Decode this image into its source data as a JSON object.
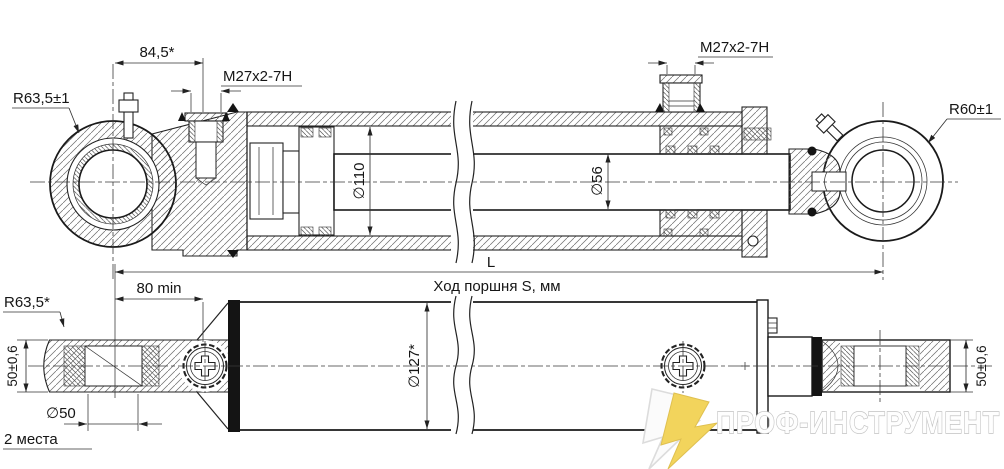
{
  "drawing": {
    "top_view": {
      "offset_dim": "84,5*",
      "port_thread_left": "M27x2-7H",
      "port_thread_right": "M27x2-7H",
      "eye_radius_left": "R63,5±1",
      "eye_radius_right": "R60±1",
      "cylinder_diameter": "∅110",
      "rod_diameter": "∅56",
      "overall_length": "L",
      "stroke_label": "Ход поршня S, мм"
    },
    "bottom_view": {
      "mount_offset": "80 min",
      "eye_radius": "R63,5*",
      "eye_width_left": "50±0,6",
      "eye_width_right": "50±0,6",
      "pin_hole_diameter": "∅50",
      "pin_hole_places": "2 места",
      "tube_diameter": "∅127*"
    },
    "line_color": "#222222"
  },
  "watermark": {
    "brand": "ПРОФ-ИНСТРУМЕНТ",
    "accent_color": "#F2D45C"
  }
}
